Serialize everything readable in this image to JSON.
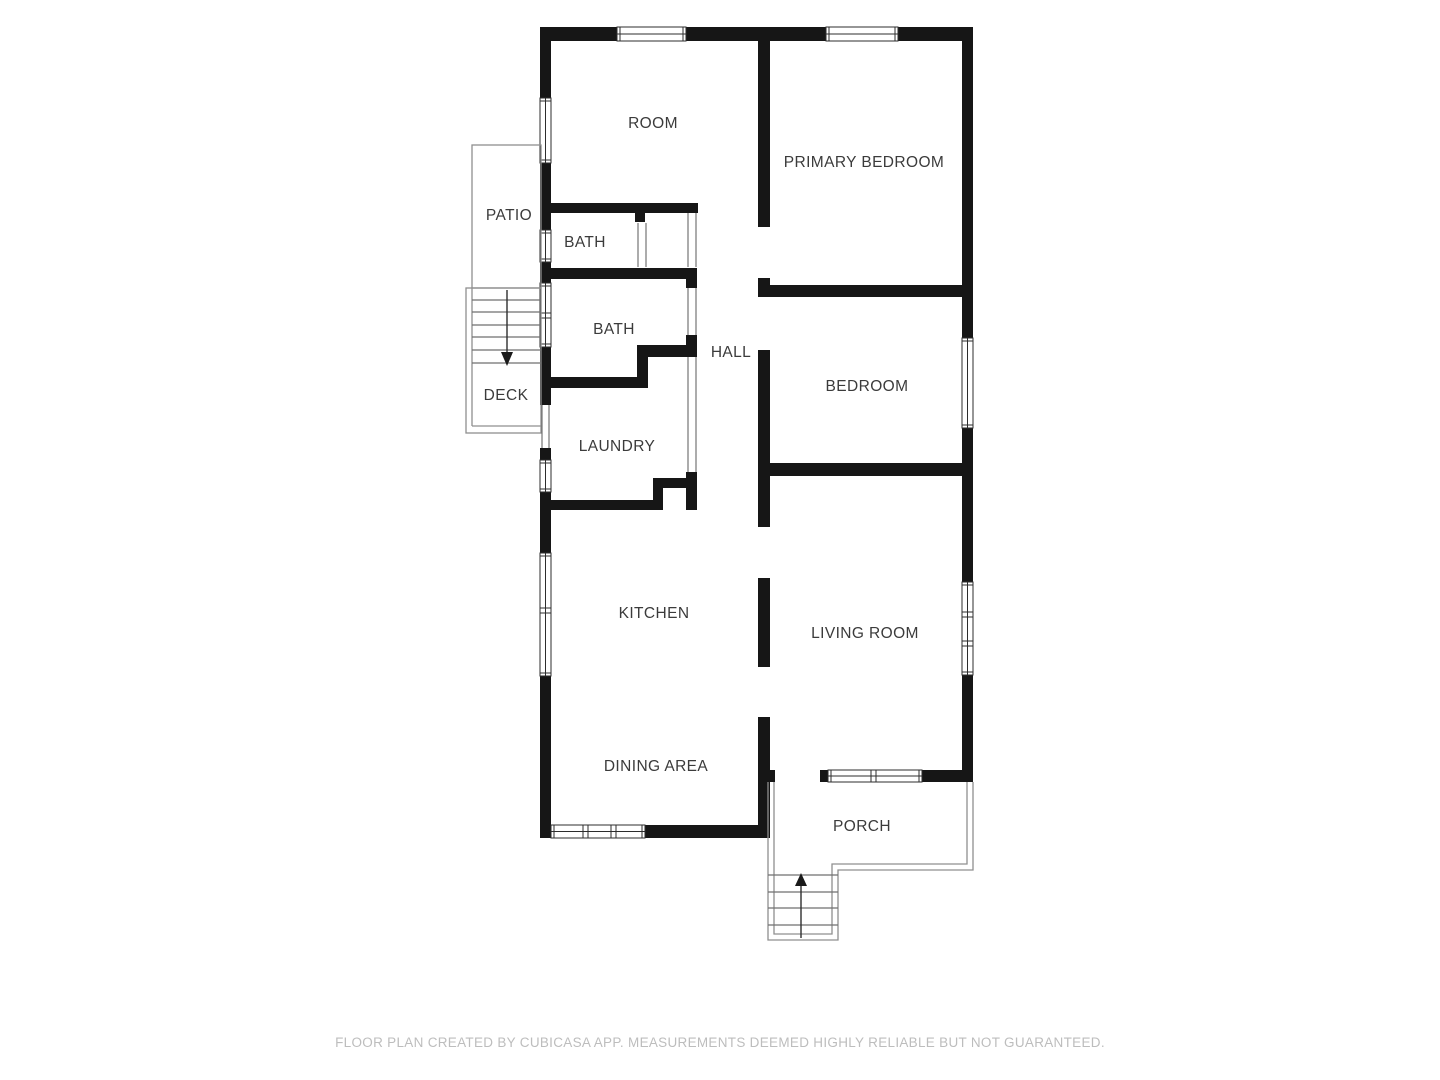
{
  "plan": {
    "footer": "FLOOR PLAN CREATED BY CUBICASA APP. MEASUREMENTS DEEMED HIGHLY RELIABLE BUT NOT GUARANTEED.",
    "colors": {
      "wall": "#161616",
      "label_text": "#3b3b3b",
      "thin_outline": "#8f8f8f",
      "footer_text": "#bdbdbd",
      "background": "#ffffff"
    },
    "rooms": [
      {
        "id": "room",
        "label": "ROOM"
      },
      {
        "id": "primary-bedroom",
        "label": "PRIMARY BEDROOM"
      },
      {
        "id": "patio",
        "label": "PATIO"
      },
      {
        "id": "bath-upper",
        "label": "BATH"
      },
      {
        "id": "bath-lower",
        "label": "BATH"
      },
      {
        "id": "hall",
        "label": "HALL"
      },
      {
        "id": "bedroom",
        "label": "BEDROOM"
      },
      {
        "id": "deck",
        "label": "DECK"
      },
      {
        "id": "laundry",
        "label": "LAUNDRY"
      },
      {
        "id": "kitchen",
        "label": "KITCHEN"
      },
      {
        "id": "living-room",
        "label": "LIVING ROOM"
      },
      {
        "id": "dining-area",
        "label": "DINING AREA"
      },
      {
        "id": "porch",
        "label": "PORCH"
      }
    ],
    "stairs": [
      {
        "id": "deck-stairs",
        "direction": "down"
      },
      {
        "id": "porch-stairs",
        "direction": "up"
      }
    ]
  }
}
